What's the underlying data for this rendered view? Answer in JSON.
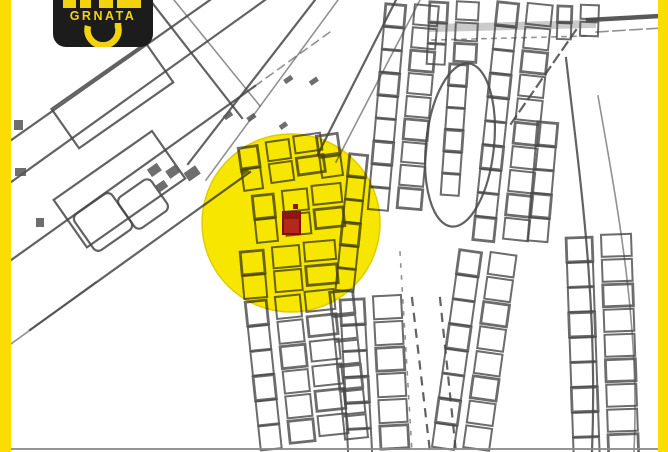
{
  "logo": {
    "brand": "GRNATA"
  },
  "map": {
    "type": "cadastral-parcel-map",
    "highlight": {
      "shape": "circle",
      "marker": "red-plot-rectangle"
    }
  },
  "colors": {
    "frame_yellow": "#fbdc03",
    "logo_bg": "#1c1c1c",
    "logo_yellow": "#f2d40e",
    "highlight_yellow": "#f6e600",
    "marker_red": "#b3271d",
    "map_line": "#474747"
  }
}
